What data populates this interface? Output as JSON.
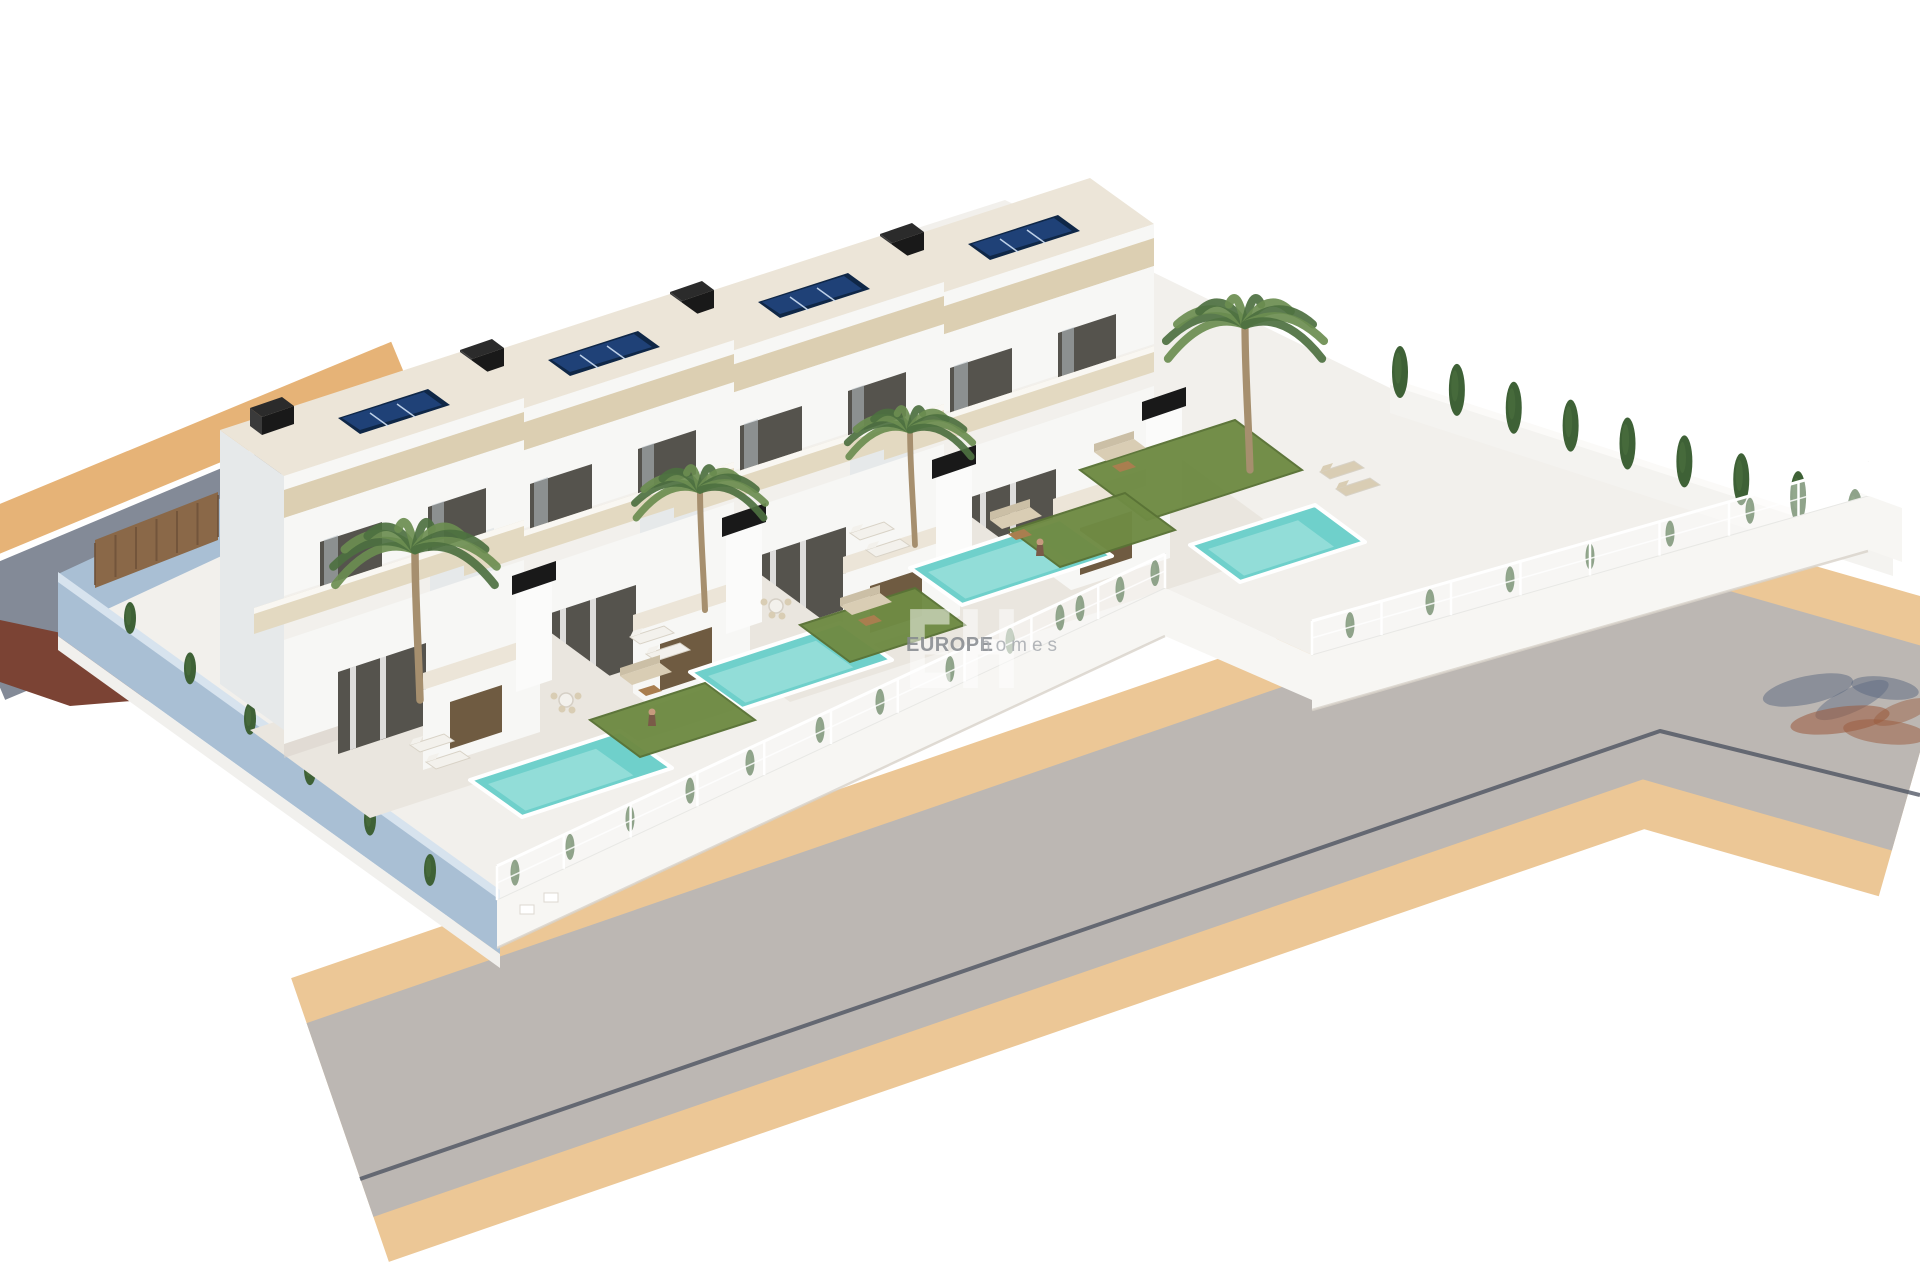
{
  "watermark": {
    "monogram": "EH",
    "brand": "EUROPE",
    "brand_suffix": "homes"
  },
  "scene": {
    "type": "3d-architectural-render",
    "subject": "Row of four modern two-storey villas with private pools beside a curved road",
    "villas": [
      {
        "id": "villa-1",
        "features": [
          "flat roof",
          "solar panels",
          "black chimney",
          "terrace",
          "private pool",
          "sun loungers",
          "palm tree",
          "lawn"
        ]
      },
      {
        "id": "villa-2",
        "features": [
          "flat roof",
          "solar panels",
          "black chimney",
          "terrace",
          "private pool",
          "outdoor dining",
          "palm tree",
          "lawn"
        ]
      },
      {
        "id": "villa-3",
        "features": [
          "flat roof",
          "solar panels",
          "black chimney",
          "terrace",
          "private pool",
          "garden sofa",
          "palm tree",
          "lawn"
        ]
      },
      {
        "id": "villa-4",
        "features": [
          "flat roof",
          "solar panels",
          "black chimney",
          "terrace",
          "private pool",
          "sun loungers",
          "palm tree",
          "large lawn"
        ]
      }
    ],
    "environment": [
      "asphalt road",
      "sand-coloured sidewalks",
      "white mesh fences",
      "blue-grey perimeter wall",
      "cypress hedge",
      "palm-tree shadow on road"
    ]
  },
  "colors": {
    "background": "#ffffff",
    "road": "#bcb7b3",
    "road_line": "#474e5c",
    "sidewalk": "#ecc796",
    "sidewalk_side": "#e6b377",
    "street": "#838a97",
    "driveway": "#7b4334",
    "plot": "#f2f0ec",
    "terrace": "#eae6df",
    "building_front": "#f7f7f5",
    "building_side": "#e6e9ea",
    "roof": "#ece5d8",
    "stone_band": "#dccfb2",
    "balcony_band": "#e3d9c1",
    "window_dark": "#55534d",
    "window_glass": "#b9c3c8",
    "chimney": "#191919",
    "solar_frame": "#0f2747",
    "solar_blue": "#1f4177",
    "solar_line": "#cfe0f5",
    "pool_water": "#6fd0cb",
    "pool_light": "#aee8e4",
    "pool_coping": "#ffffff",
    "lawn": "#6f8b44",
    "lawn_dark": "#5a7336",
    "cypress": "#3e6136",
    "palm_green": "#6b8d50",
    "palm_dark": "#4d7040",
    "palm_trunk": "#a68f6e",
    "wall_blue": "#a9bfd4",
    "wall_blue_top": "#d7e3ee",
    "curb": "#f1f0ed",
    "fence_wall": "#f7f6f3",
    "fence_mesh": "rgba(255,255,255,0.42)",
    "fence_post": "#ffffff",
    "rear_wall": "#f4f3f0",
    "kitchen_wood": "#6f5b41",
    "wood_fence": "#8a6848",
    "wood_fence_line": "#6e5138",
    "furniture_white": "#f3f1ec",
    "furniture_beige": "#d9cdb4",
    "furniture_beige_dark": "#cbbfa6",
    "furniture_wood": "#a97e4f",
    "skin": "#c79a7e",
    "shadow_slate": "#5a6880",
    "shadow_rust": "#9a5a3c",
    "watermark_white": "#ffffff",
    "watermark_brand": "#85898e",
    "watermark_suffix": "#a8acb1"
  }
}
